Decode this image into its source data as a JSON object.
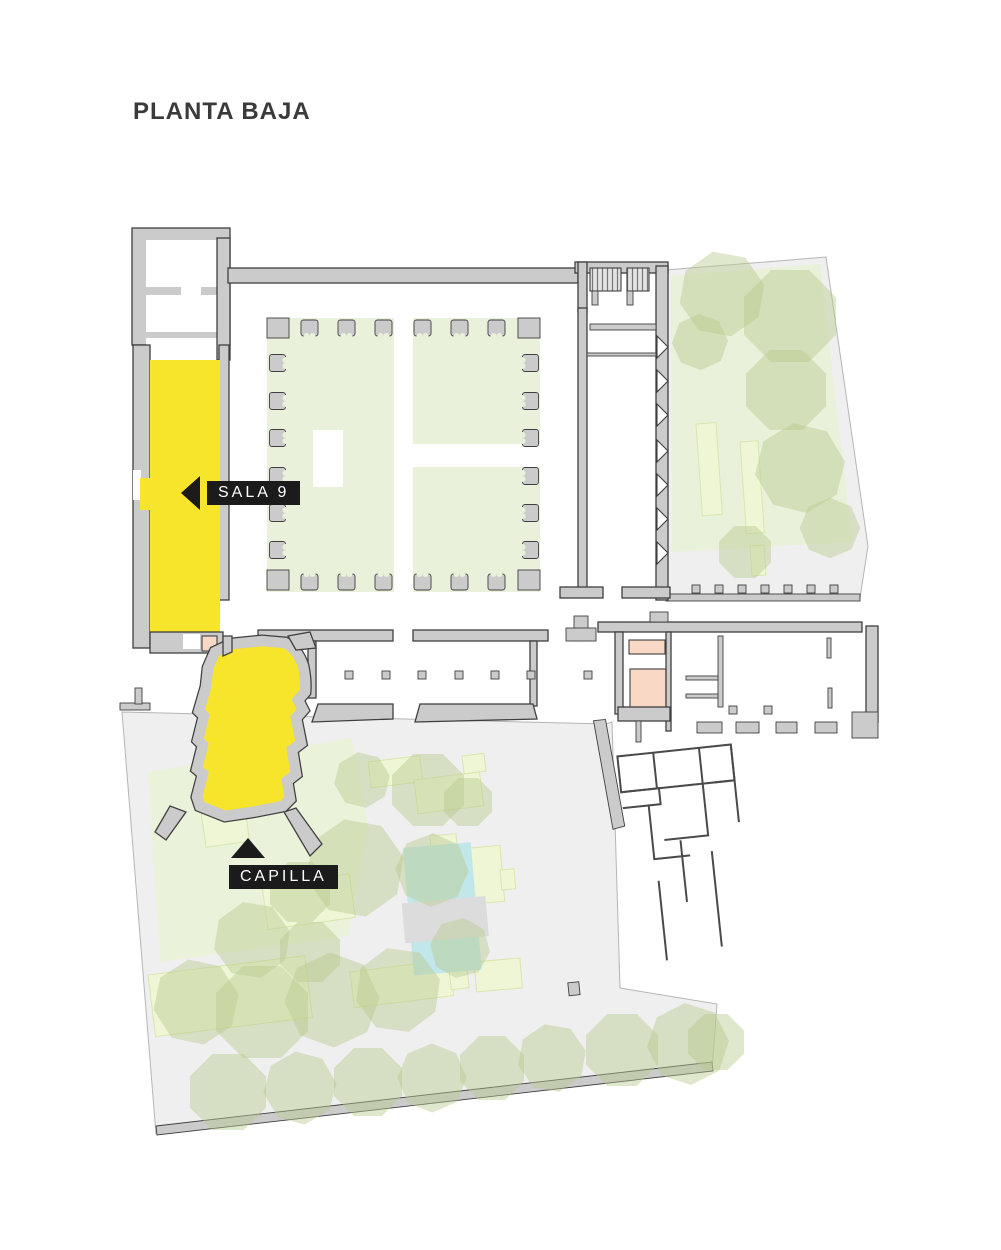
{
  "title": "PLANTA BAJA",
  "labels": {
    "sala9": "SALA 9",
    "capilla": "CAPILLA"
  },
  "colors": {
    "highlight": "#f7e52b",
    "wall-fill": "#cbcbcb",
    "wall-line": "#3f3f3f",
    "courtyard-green": "#eaf1da",
    "garden-gray": "#efefef",
    "garden-line": "#b5b5b5",
    "bed-green": "#eef6d6",
    "bed-line": "#d9e6ae",
    "tree-green": "#b9c98f",
    "pale-bed": "#ebf2da",
    "pool-blue": "#c2e7ea",
    "pool-bridge": "#dcdcdc",
    "pink": "#f9d9c5",
    "label-bg": "#1b1b1b",
    "label-text": "#ffffff",
    "title-color": "#3a3a3a",
    "thin-line": "#4a4a4a"
  }
}
